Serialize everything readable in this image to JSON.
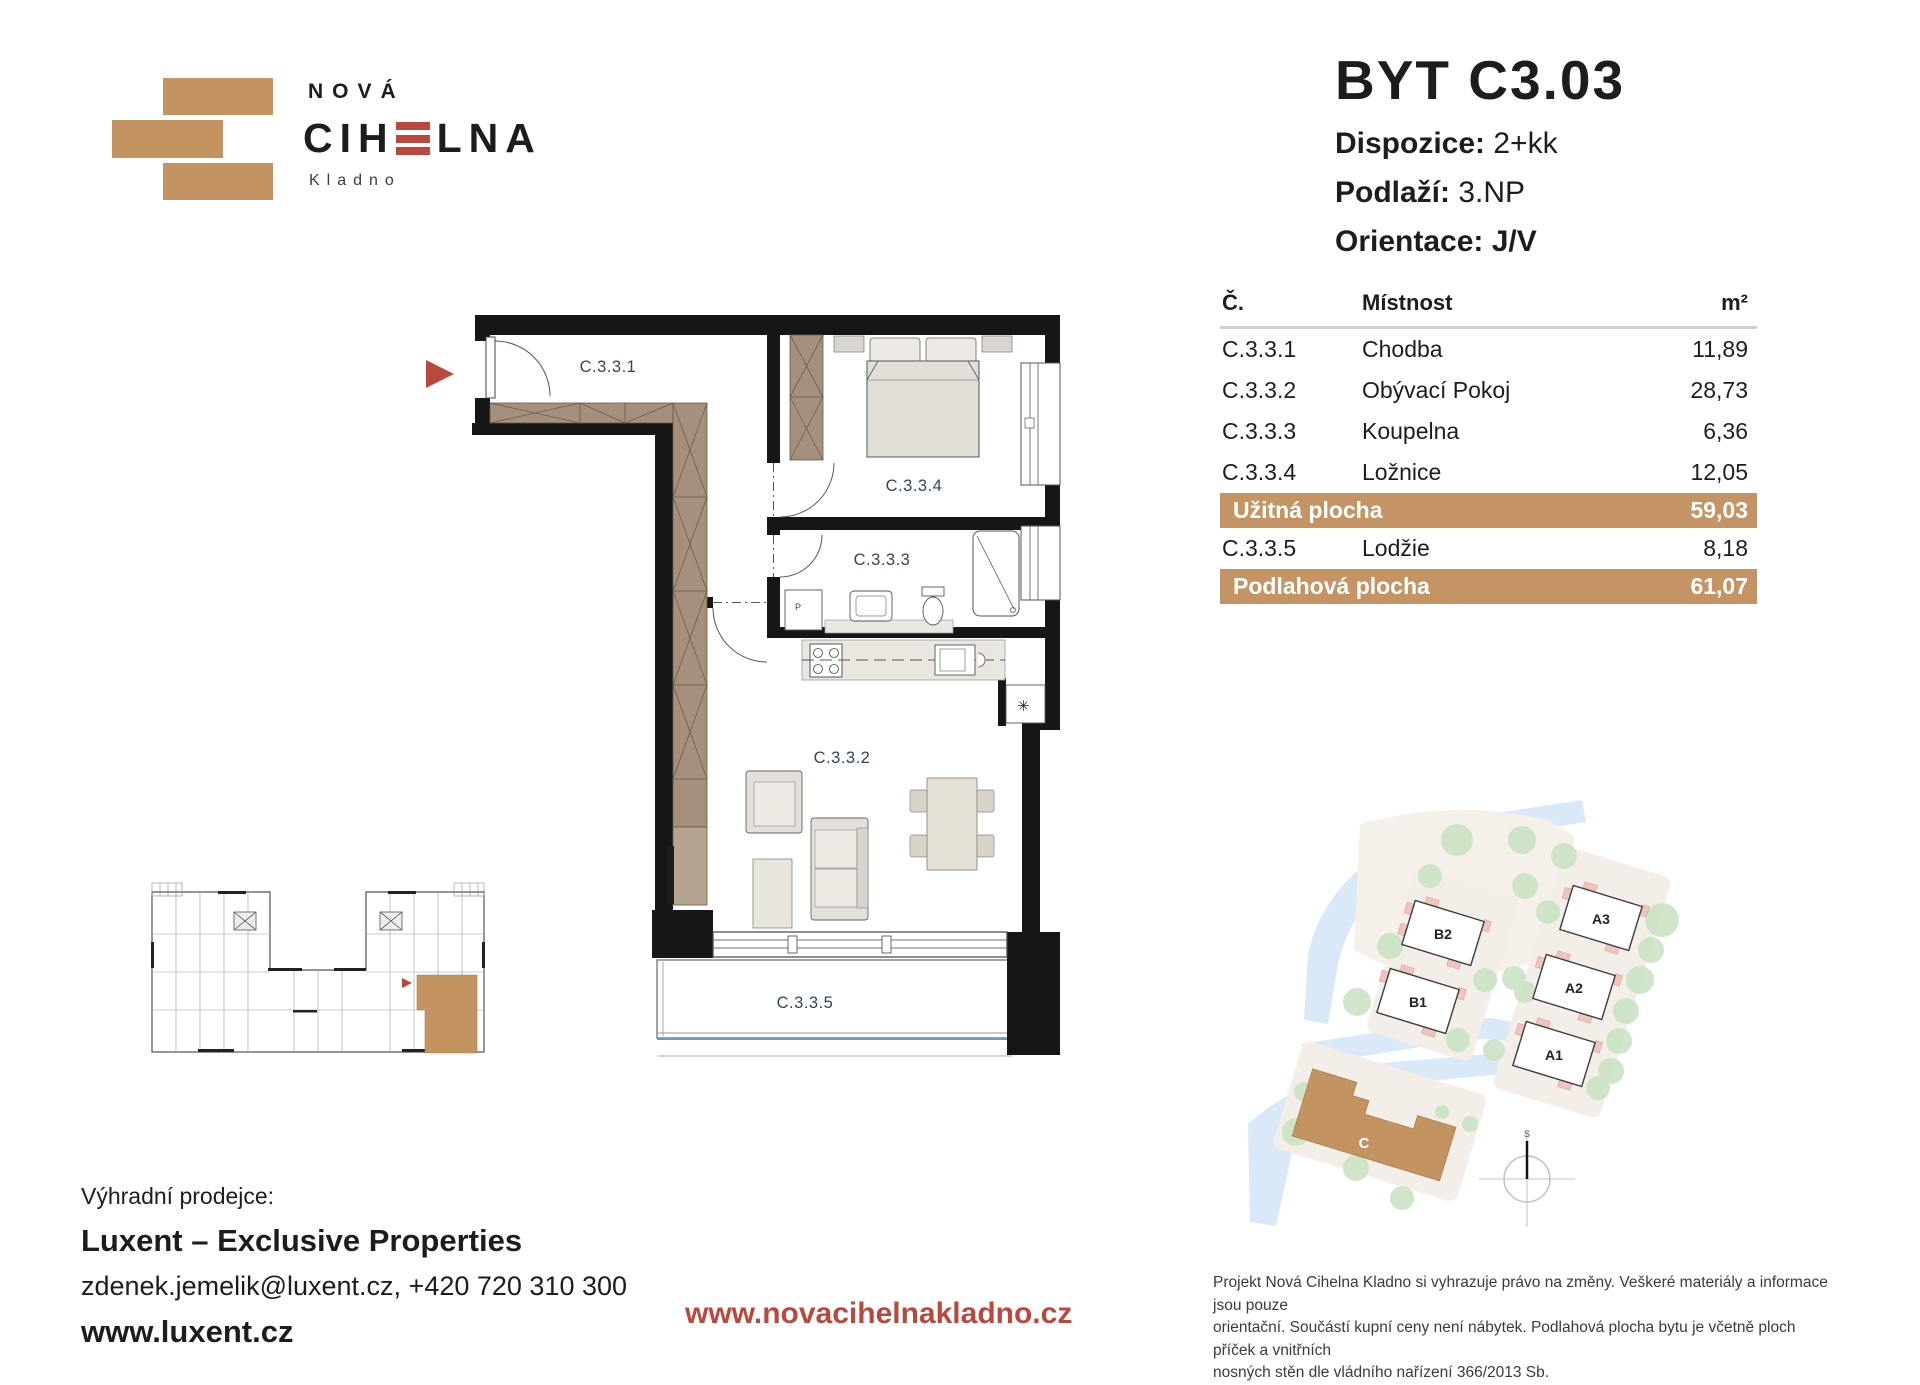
{
  "logo": {
    "top": "NOVÁ",
    "main_pre": "CIH",
    "main_post": "LNA",
    "sub": "Kladno"
  },
  "title": {
    "unit": "BYT C3.03",
    "specs": [
      {
        "label": "Dispozice:",
        "value": "2+kk"
      },
      {
        "label": "Podlaží:",
        "value": "3.NP"
      },
      {
        "label": "Orientace:",
        "value": "J/V"
      }
    ]
  },
  "table": {
    "headers": {
      "num": "Č.",
      "room": "Místnost",
      "area": "m²"
    },
    "rows": [
      {
        "num": "C.3.3.1",
        "room": "Chodba",
        "area": "11,89"
      },
      {
        "num": "C.3.3.2",
        "room": "Obývací Pokoj",
        "area": "28,73"
      },
      {
        "num": "C.3.3.3",
        "room": "Koupelna",
        "area": "6,36"
      },
      {
        "num": "C.3.3.4",
        "room": "Ložnice",
        "area": "12,05"
      }
    ],
    "usable": {
      "label": "Užitná plocha",
      "area": "59,03"
    },
    "extra": {
      "num": "C.3.3.5",
      "room": "Lodžie",
      "area": "8,18"
    },
    "total": {
      "label": "Podlahová plocha",
      "area": "61,07"
    }
  },
  "plan": {
    "labels": {
      "hall": "C.3.3.1",
      "living": "C.3.3.2",
      "bath": "C.3.3.3",
      "bed": "C.3.3.4",
      "loggia": "C.3.3.5"
    },
    "washer": "P",
    "vent": "✳"
  },
  "site": {
    "buildings": [
      {
        "id": "B2"
      },
      {
        "id": "B1"
      },
      {
        "id": "A3"
      },
      {
        "id": "A2"
      },
      {
        "id": "A1"
      },
      {
        "id": "C"
      }
    ],
    "compass": "S"
  },
  "footer": {
    "heading": "Výhradní prodejce:",
    "company": "Luxent – Exclusive Properties",
    "contact": "zdenek.jemelik@luxent.cz, +420 720 310 300",
    "web": "www.luxent.cz",
    "project_web": "www.novacihelnakladno.cz",
    "disclaimer_lines": [
      "Projekt Nová Cihelna Kladno si vyhrazuje právo na změny. Veškeré materiály a informace jsou pouze",
      "orientační. Součástí kupní ceny není nábytek. Podlahová plocha bytu je včetně ploch příček a vnitřních",
      "nosných stěn dle vládního nařízení 366/2013 Sb."
    ]
  },
  "colors": {
    "accent_tan": "#c39462",
    "accent_red": "#b9493e",
    "wall_black": "#161616",
    "room_label": "#31455a",
    "site_green": "#cbe3c4",
    "site_blue": "#d9e9f7"
  }
}
